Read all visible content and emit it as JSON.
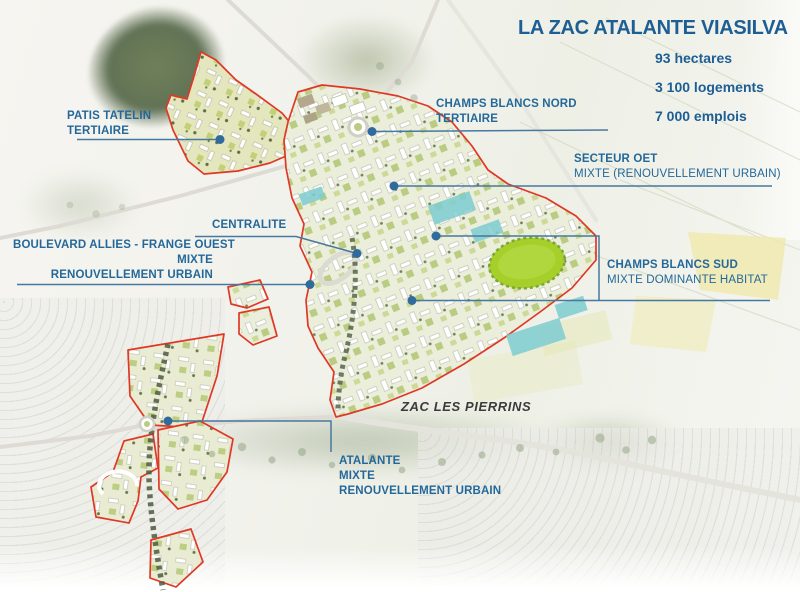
{
  "title": "LA ZAC ATALANTE VIASILVA",
  "stats": {
    "hectares": "93 hectares",
    "logements": "3 100 logements",
    "emplois": "7 000 emplois"
  },
  "labels": {
    "patis_tatelin": {
      "line1": "PATIS TATELIN",
      "line2": "TERTIAIRE"
    },
    "champs_blancs_nord": {
      "line1": "CHAMPS BLANCS NORD",
      "line2": "TERTIAIRE"
    },
    "secteur_oet": {
      "line1": "SECTEUR OET",
      "line2": "MIXTE (RENOUVELLEMENT URBAIN)"
    },
    "centralite": {
      "line1": "CENTRALITE"
    },
    "boulevard_allies": {
      "line1": "BOULEVARD ALLIES - FRANGE OUEST",
      "line2": "MIXTE",
      "line3": "RENOUVELLEMENT URBAIN"
    },
    "champs_blancs_sud": {
      "line1": "CHAMPS BLANCS SUD",
      "line2": "MIXTE DOMINANTE HABITAT"
    },
    "zac_les_pierrins": {
      "line1": "ZAC LES PIERRINS"
    },
    "atalante": {
      "line1": "ATALANTE",
      "line2": "MIXTE",
      "line3": "RENOUVELLEMENT URBAIN"
    }
  },
  "colors": {
    "title_blue": "#1d5e94",
    "label_blue": "#24689a",
    "leader_blue": "#47789f",
    "anchor_dot_blue": "#2f6b9d",
    "zone_outline_red": "#df3826",
    "park_green": "#a6cf2a",
    "plan_block_green": "#b9cc82",
    "water_teal": "#7fcdd1",
    "field_yellow": "#efe9ab"
  },
  "icons": {
    "anchor_dot": "map-anchor-dot",
    "roundabout": "roundabout"
  }
}
